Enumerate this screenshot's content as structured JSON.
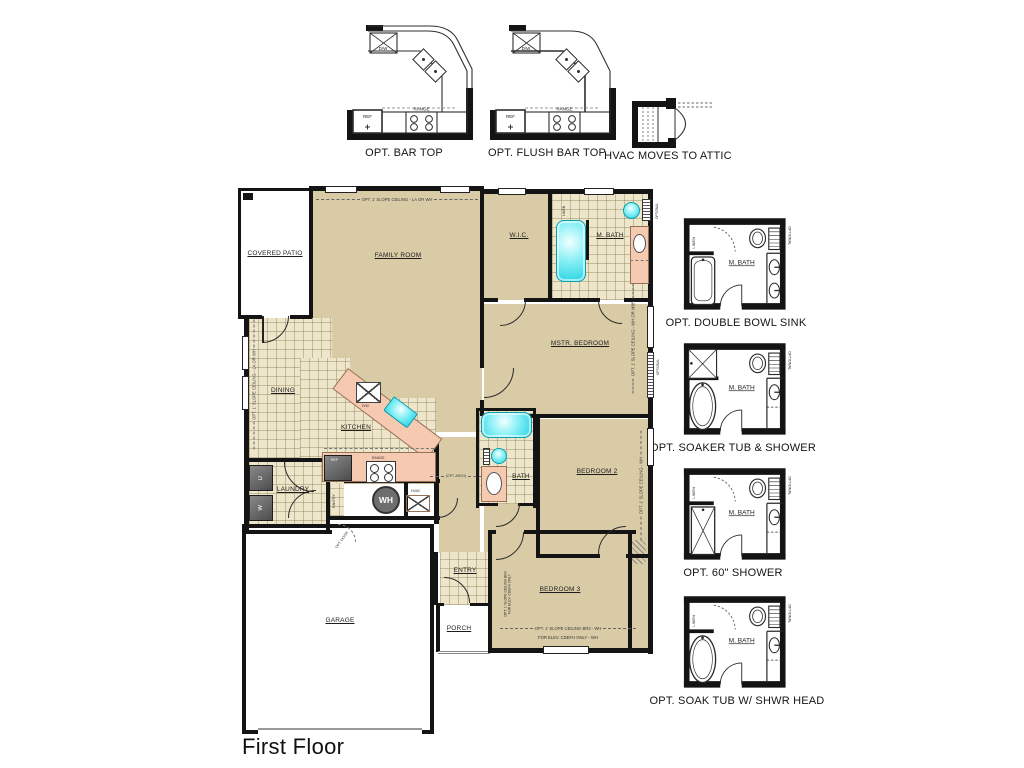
{
  "title": "First Floor",
  "top_options": {
    "bar_top": {
      "label": "OPT. BAR TOP",
      "dw": "D/W",
      "ref": "REF",
      "range": "RANGE"
    },
    "flush_bar_top": {
      "label": "OPT. FLUSH BAR TOP",
      "dw": "D/W",
      "ref": "REF",
      "range": "RANGE"
    },
    "hvac_attic": {
      "label": "HVAC MOVES TO ATTIC"
    }
  },
  "side_options": [
    {
      "label": "OPT. DOUBLE BOWL SINK",
      "room": "M. BATH",
      "linen": "LINEN",
      "optional": "OPTIONAL"
    },
    {
      "label": "OPT. SOAKER TUB & SHOWER",
      "room": "M. BATH",
      "optional": "OPTIONAL"
    },
    {
      "label": "OPT. 60\" SHOWER",
      "room": "M. BATH",
      "linen": "LINEN",
      "optional": "OPTIONAL"
    },
    {
      "label": "OPT. SOAK TUB W/ SHWR HEAD",
      "room": "M. BATH",
      "linen": "LINEN",
      "optional": "OPTIONAL"
    }
  ],
  "rooms": {
    "covered_patio": "COVERED PATIO",
    "family_room": "FAMILY ROOM",
    "wic": "W.I.C.",
    "m_bath": "M. BATH",
    "mstr_bedroom": "MSTR. BEDROOM",
    "dining": "DINING",
    "kitchen": "KITCHEN",
    "laundry": "LAUNDRY",
    "pantry": "PANTRY",
    "bath": "BATH",
    "bedroom2": "BEDROOM 2",
    "bedroom3": "BEDROOM 3",
    "entry": "ENTRY",
    "porch": "PORCH",
    "garage": "GARAGE",
    "linen": "LINEN"
  },
  "labels": {
    "optional": "OPTIONAL",
    "wh": "WH",
    "hvac": "HVAC",
    "ref": "REF",
    "range": "RANGE",
    "dw": "D/W",
    "washer": "W",
    "dryer": "D"
  },
  "notes": {
    "family_ceiling": "OPT. 1' SLOPE CEILING - LA OR WH",
    "dining_ceiling": "OPT. 1' SLOPE CEILING - LA OR WH",
    "mstr_ceiling": "OPT. 1' SLOPE CEILING - WH OR MBR",
    "bedroom2_ceiling": "OPT. 1' SLOPE CEILING - WH",
    "bedroom3_ceiling": "OPT. 1' SLOPE CEILING BR3 - WH",
    "bedroom3_elev": "FOR ELEV. CDEFH ONLY - WH",
    "bedroom3_side1": "OPT. 1' SLOPE CEILING BR3",
    "bedroom3_side2": "FOR ELEV. CDEFH ONLY",
    "opt_arch": "(OPT. ARCH)",
    "opt_door": "OPT. DOOR"
  },
  "colors": {
    "room_tan": "#d8cba6",
    "tile_cream": "#eee6ca",
    "counter_salmon": "#f5cab0",
    "fixture_cyan": "#3adde9",
    "wall": "#141414",
    "appliance_gray": "#606060"
  }
}
